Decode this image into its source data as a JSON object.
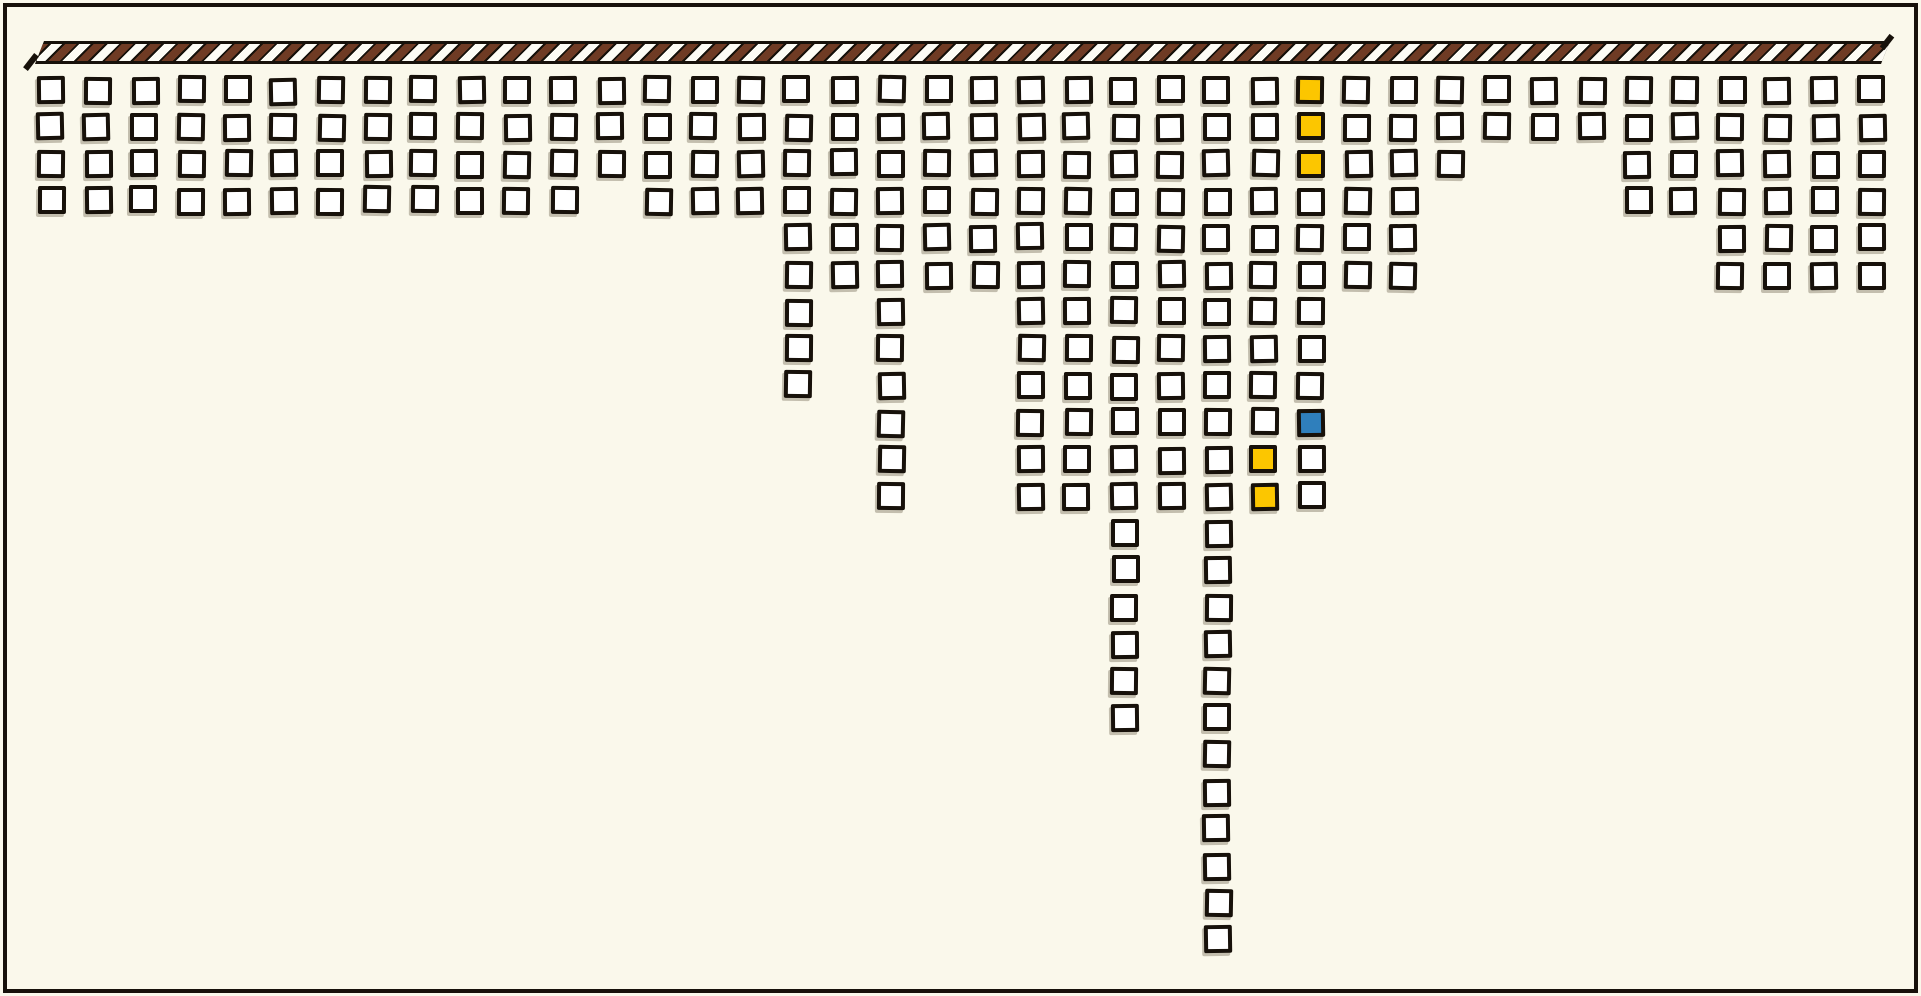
{
  "figure": {
    "style": "xkcd-hand-drawn",
    "background_color": "#FAF8EB",
    "ink_color": "#17110A",
    "rope_bar": {
      "description": "horizontal rope/strap with diagonal stripes from which all squares hang",
      "stripe_brown": "#6F3B24",
      "stripe_white": "#FDFCF5",
      "band_black": "#17110A"
    },
    "square_colors": {
      "fill": "#FFFFFF",
      "border": "#17110A",
      "highlight_yellow": "#FCC600",
      "highlight_blue": "#2F7FBC"
    }
  },
  "chart_data": {
    "type": "pictogram",
    "title": "",
    "xlabel": "",
    "ylabel": "",
    "description": "Grid pictogram of outlined squares hanging in columns below a striped rope bar; columns grow downward with varying lengths. No axis labels or text are present.",
    "legend": [],
    "grid": false,
    "columns": 40,
    "categories": [
      1,
      2,
      3,
      4,
      5,
      6,
      7,
      8,
      9,
      10,
      11,
      12,
      13,
      14,
      15,
      16,
      17,
      18,
      19,
      20,
      21,
      22,
      23,
      24,
      25,
      26,
      27,
      28,
      29,
      30,
      31,
      32,
      33,
      34,
      35,
      36,
      37,
      38,
      39,
      40
    ],
    "values": [
      4,
      4,
      4,
      4,
      4,
      4,
      4,
      4,
      4,
      4,
      4,
      4,
      3,
      4,
      4,
      4,
      9,
      6,
      12,
      6,
      6,
      12,
      12,
      18,
      12,
      24,
      12,
      12,
      6,
      6,
      3,
      2,
      2,
      2,
      4,
      4,
      6,
      6,
      6,
      6
    ],
    "total_squares": 257,
    "max_column_length": 24,
    "highlighted_squares": [
      {
        "column": 28,
        "row": 1,
        "color": "yellow"
      },
      {
        "column": 28,
        "row": 2,
        "color": "yellow"
      },
      {
        "column": 28,
        "row": 3,
        "color": "yellow"
      },
      {
        "column": 28,
        "row": 10,
        "color": "blue"
      },
      {
        "column": 27,
        "row": 11,
        "color": "yellow"
      },
      {
        "column": 27,
        "row": 12,
        "color": "yellow"
      }
    ]
  }
}
